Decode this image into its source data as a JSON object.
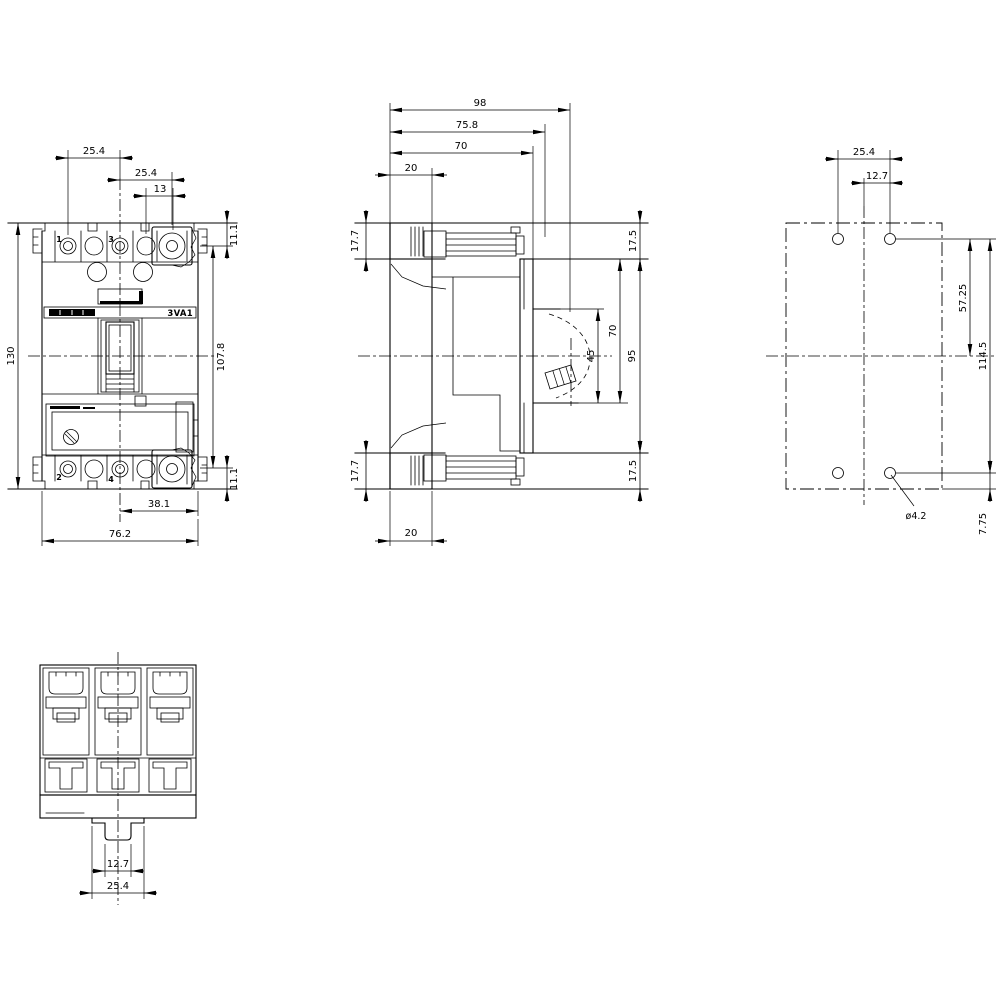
{
  "drawing": {
    "front_view": {
      "pitch_pole1_pole3": "25.4",
      "pitch_pole3_pole5": "25.4",
      "lug_opening": "13",
      "top_terminal_offset": "11.1",
      "height": "130",
      "terminal_span": "107.8",
      "bottom_terminal_offset": "11.1",
      "center_to_edge": "38.1",
      "width": "76.2",
      "pole1": "1",
      "pole3": "3",
      "pole2": "2",
      "pole4": "4",
      "series": "3VA1"
    },
    "side_view": {
      "depth_total": "98",
      "depth_escutcheon": "75.8",
      "depth_cover": "70",
      "top_terminal_depth": "20",
      "top_terminal_height": "17.7",
      "bottom_terminal_height": "17.7",
      "bottom_terminal_depth": "20",
      "top_clearance": "17.5",
      "span_95": "95",
      "handle_span_70": "70",
      "handle_window_45": "45",
      "bottom_clearance": "17.5"
    },
    "drilling_view": {
      "hole_pitch_x": "25.4",
      "half_pitch": "12.7",
      "hole_to_center": "57.25",
      "hole_pitch_y": "114.5",
      "bottom_edge_offset": "7.75",
      "hole_diameter": "ø4.2"
    },
    "bottom_view": {
      "clip_inner_width": "12.7",
      "clip_outer_width": "25.4"
    }
  }
}
